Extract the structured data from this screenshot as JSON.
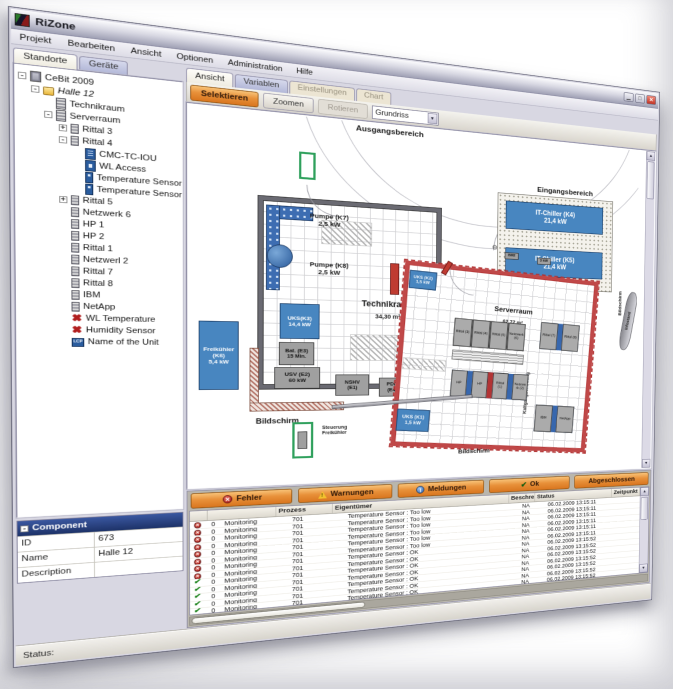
{
  "window": {
    "title": "RiZone",
    "status_label": "Status:",
    "side_tag": "Schließen"
  },
  "menu": [
    {
      "label": "Projekt"
    },
    {
      "label": "Bearbeiten"
    },
    {
      "label": "Ansicht"
    },
    {
      "label": "Optionen"
    },
    {
      "label": "Administration"
    },
    {
      "label": "Hilfe"
    }
  ],
  "left_tabs": [
    {
      "label": "Standorte",
      "state": "active"
    },
    {
      "label": "Geräte",
      "state": "normal"
    }
  ],
  "tree": [
    {
      "label": "CeBit 2009",
      "level": 0,
      "exp": "-",
      "icon": "building",
      "style": ""
    },
    {
      "label": "Halle 12",
      "level": 1,
      "exp": "-",
      "icon": "folder",
      "style": "italic"
    },
    {
      "label": "Technikraum",
      "level": 2,
      "exp": "",
      "icon": "roomrack",
      "style": ""
    },
    {
      "label": "Serverraum",
      "level": 2,
      "exp": "-",
      "icon": "roomrack",
      "style": ""
    },
    {
      "label": "Rittal 3",
      "level": 3,
      "exp": "+",
      "icon": "rack",
      "style": ""
    },
    {
      "label": "Rittal 4",
      "level": 3,
      "exp": "-",
      "icon": "rack",
      "style": ""
    },
    {
      "label": "CMC-TC-IOU",
      "level": 4,
      "exp": "",
      "icon": "blue-io",
      "style": ""
    },
    {
      "label": "WL Access",
      "level": 4,
      "exp": "",
      "icon": "blue-ap",
      "style": ""
    },
    {
      "label": "Temperature Sensor",
      "level": 4,
      "exp": "",
      "icon": "blue-sensor",
      "style": ""
    },
    {
      "label": "Temperature Sensor",
      "level": 4,
      "exp": "",
      "icon": "blue-sensor",
      "style": ""
    },
    {
      "label": "Rittal 5",
      "level": 3,
      "exp": "+",
      "icon": "rack",
      "style": ""
    },
    {
      "label": "Netzwerk 6",
      "level": 3,
      "exp": "",
      "icon": "rack",
      "style": ""
    },
    {
      "label": "HP 1",
      "level": 3,
      "exp": "",
      "icon": "rack",
      "style": ""
    },
    {
      "label": "HP 2",
      "level": 3,
      "exp": "",
      "icon": "rack",
      "style": ""
    },
    {
      "label": "Rittal 1",
      "level": 3,
      "exp": "",
      "icon": "rack",
      "style": ""
    },
    {
      "label": "Netzwerl 2",
      "level": 3,
      "exp": "",
      "icon": "rack",
      "style": ""
    },
    {
      "label": "Rittal 7",
      "level": 3,
      "exp": "",
      "icon": "rack",
      "style": ""
    },
    {
      "label": "Rittal 8",
      "level": 3,
      "exp": "",
      "icon": "rack",
      "style": ""
    },
    {
      "label": "IBM",
      "level": 3,
      "exp": "",
      "icon": "rack",
      "style": ""
    },
    {
      "label": "NetApp",
      "level": 3,
      "exp": "",
      "icon": "rack",
      "style": ""
    },
    {
      "label": "WL Temperature",
      "level": 3,
      "exp": "",
      "icon": "red-x",
      "style": ""
    },
    {
      "label": "Humidity Sensor",
      "level": 3,
      "exp": "",
      "icon": "red-x",
      "style": ""
    },
    {
      "label": "Name of the Unit",
      "level": 3,
      "exp": "",
      "icon": "lcp",
      "style": ""
    }
  ],
  "component": {
    "header": "Component",
    "rows": [
      {
        "label": "ID",
        "value": "673"
      },
      {
        "label": "Name",
        "value": "Halle 12"
      },
      {
        "label": "Description",
        "value": ""
      }
    ]
  },
  "right_tabs": [
    {
      "label": "Ansicht",
      "state": "active"
    },
    {
      "label": "Variablen",
      "state": "normal"
    },
    {
      "label": "Einstellungen",
      "state": "disabled"
    },
    {
      "label": "Chart",
      "state": "disabled"
    }
  ],
  "toolbar": {
    "buttons": [
      {
        "label": "Selektieren",
        "state": "orange"
      },
      {
        "label": "Zoomen",
        "state": "plain"
      },
      {
        "label": "Rotieren",
        "state": "disabled"
      }
    ],
    "view_select": "Grundriss"
  },
  "plan": {
    "ausgangsbereich": "Ausgangsbereich",
    "eingangsbereich": "Eingangsbereich",
    "technikraum_name": "Technikraum",
    "technikraum_area": "34,30 m²",
    "serverraum_name": "Serverraum",
    "serverraum_area": "62,72 m²",
    "fenster": "Fenster",
    "kaltgangschottung": "Kaltgangschottung",
    "bildschirm": "Bildschirm",
    "infostand": "Infostand",
    "steuerung_line1": "Steuerung",
    "steuerung_line2": "Freikühler",
    "symbols": {
      "bm2": "BM2",
      "kw3": "3 kW",
      "valve": "⊖"
    },
    "equipment": {
      "pumpe_k7_name": "Pumpe (K7)",
      "pumpe_k7_power": "2,5 kW",
      "pumpe_k8_name": "Pumpe (K8)",
      "pumpe_k8_power": "2,5 kW",
      "chiller_k4_name": "IT-Chiller (K4)",
      "chiller_k4_power": "21,4 kW",
      "chiller_k5_name": "IT-Chiller (K5)",
      "chiller_k5_power": "21,4 kW",
      "uks_k2_name": "UKS (K2)",
      "uks_k2_power": "1,5 kW",
      "uks_k3_name": "UKS(K3)",
      "uks_k3_power": "14,4 kW",
      "uks_k1_name": "UKS (K1)",
      "uks_k1_power": "1,5 kW",
      "freikuehler_name": "Freikühler",
      "freikuehler_id": "(K6)",
      "freikuehler_power": "5,4 kW",
      "bat_name": "Bat. (E3)",
      "bat_power": "15 Min.",
      "usv_name": "USV (E2)",
      "usv_power": "60 kW",
      "nshv_name": "NSHV",
      "nshv_id": "(E1)",
      "pdr_name": "PDR",
      "pdr_id": "(E4)",
      "schrank_name": "Steuerschrank",
      "schrank_power": "0,27 kW"
    },
    "racks_top": [
      "Rittal (3)",
      "Rittal (4)",
      "Rittal (5)",
      "Netzwerk (6)"
    ],
    "racks_bottom": [
      "HP",
      "HP",
      "Rittal (1)",
      "Netzwerk (2)"
    ],
    "racks_right1": [
      "Rittal (7)",
      "Rittal (8)"
    ],
    "racks_right2": [
      "IBM",
      "NetApp"
    ]
  },
  "messages": {
    "filters": [
      {
        "label": "Fehler",
        "icon": "f-error"
      },
      {
        "label": "Warnungen",
        "icon": "f-warn"
      },
      {
        "label": "Meldungen",
        "icon": "f-info"
      },
      {
        "label": "Ok",
        "icon": "f-ok"
      },
      {
        "label": "Abgeschlossen",
        "icon": ""
      }
    ],
    "columns": [
      "",
      "",
      "Prozess",
      "Eigentümer",
      "Beschreibung",
      "Status",
      "Zeitpunkt"
    ],
    "rows": [
      {
        "icon": "error",
        "count": "0",
        "process": "Monitoring",
        "owner": "701",
        "desc": "Temperature Sensor  :  Too low",
        "status": "NA",
        "time": "06.02.2009 13:15:11"
      },
      {
        "icon": "error",
        "count": "0",
        "process": "Monitoring",
        "owner": "701",
        "desc": "Temperature Sensor  :  Too low",
        "status": "NA",
        "time": "06.02.2009 13:15:11"
      },
      {
        "icon": "error",
        "count": "0",
        "process": "Monitoring",
        "owner": "701",
        "desc": "Temperature Sensor  :  Too low",
        "status": "NA",
        "time": "06.02.2009 13:15:11"
      },
      {
        "icon": "error",
        "count": "0",
        "process": "Monitoring",
        "owner": "701",
        "desc": "Temperature Sensor  :  Too low",
        "status": "NA",
        "time": "06.02.2009 13:15:11"
      },
      {
        "icon": "error",
        "count": "0",
        "process": "Monitoring",
        "owner": "701",
        "desc": "Temperature Sensor  :  Too low",
        "status": "NA",
        "time": "06.02.2009 13:15:11"
      },
      {
        "icon": "error",
        "count": "0",
        "process": "Monitoring",
        "owner": "701",
        "desc": "Temperature Sensor  :  Too low",
        "status": "NA",
        "time": "06.02.2009 13:15:11"
      },
      {
        "icon": "error",
        "count": "0",
        "process": "Monitoring",
        "owner": "701",
        "desc": "Temperature Sensor  :  OK",
        "status": "NA",
        "time": "06.02.2009 13:15:52"
      },
      {
        "icon": "error",
        "count": "0",
        "process": "Monitoring",
        "owner": "701",
        "desc": "Temperature Sensor  :  OK",
        "status": "NA",
        "time": "06.02.2009 13:15:52"
      },
      {
        "icon": "ok",
        "count": "0",
        "process": "Monitoring",
        "owner": "701",
        "desc": "Temperature Sensor  :  OK",
        "status": "NA",
        "time": "06.02.2009 13:15:52"
      },
      {
        "icon": "ok",
        "count": "0",
        "process": "Monitoring",
        "owner": "701",
        "desc": "Temperature Sensor  :  OK",
        "status": "NA",
        "time": "06.02.2009 13:15:52"
      },
      {
        "icon": "ok",
        "count": "0",
        "process": "Monitoring",
        "owner": "701",
        "desc": "Temperature Sensor  :  OK",
        "status": "NA",
        "time": "06.02.2009 13:15:52"
      },
      {
        "icon": "ok",
        "count": "0",
        "process": "Monitoring",
        "owner": "701",
        "desc": "Temperature Sensor  :  OK",
        "status": "NA",
        "time": "06.02.2009 13:15:52"
      },
      {
        "icon": "ok",
        "count": "0",
        "process": "Monitoring",
        "owner": "701",
        "desc": "Temperature Sensor  :  OK",
        "status": "NA",
        "time": "06.02.2009 13:15:52"
      },
      {
        "icon": "ok",
        "count": "0",
        "process": "Monitoring",
        "owner": "701",
        "desc": "Temperature Sensor  :  OK",
        "status": "NA",
        "time": "06.02.2009 13:15:52"
      }
    ]
  }
}
